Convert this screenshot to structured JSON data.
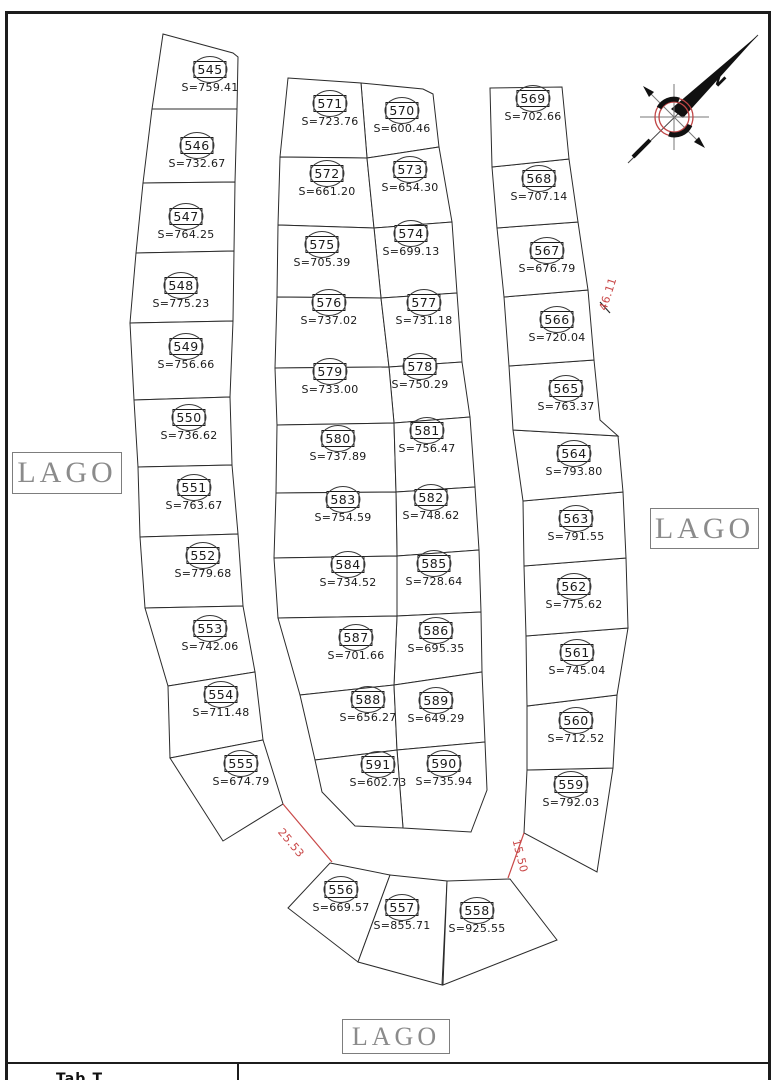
{
  "map": {
    "north_label": "N",
    "line_color": "#2b2b2b",
    "red_color": "#c94848",
    "lago_labels": [
      {
        "text": "LAGO"
      },
      {
        "text": "LAGO"
      },
      {
        "text": "LAGO"
      }
    ],
    "dimensions": [
      {
        "value": "25.53",
        "x": 291,
        "y": 843,
        "rotate": 50,
        "line": [
          283,
          804,
          332,
          862
        ],
        "line_color": "#c94848"
      },
      {
        "value": "15.50",
        "x": 520,
        "y": 856,
        "rotate": 76,
        "line": [
          524,
          833,
          508,
          878
        ],
        "line_color": "#c94848"
      },
      {
        "value": "46.11",
        "x": 608,
        "y": 294,
        "rotate": -72,
        "line": [
          600,
          302,
          610,
          313
        ],
        "line_color": "#2b2b2b"
      }
    ],
    "lots": [
      {
        "num": "545",
        "area": "S=759.41",
        "poly": "163,34 233,53 238,57 237,109 152,109",
        "lx": 210,
        "ly": 72
      },
      {
        "num": "546",
        "area": "S=732.67",
        "poly": "152,109 237,109 235,182 143,183",
        "lx": 197,
        "ly": 148
      },
      {
        "num": "547",
        "area": "S=764.25",
        "poly": "143,183 235,182 234,251 136,253",
        "lx": 186,
        "ly": 219
      },
      {
        "num": "548",
        "area": "S=775.23",
        "poly": "136,253 234,251 233,321 130,323",
        "lx": 181,
        "ly": 288
      },
      {
        "num": "549",
        "area": "S=756.66",
        "poly": "130,323 233,321 230,397 134,400",
        "lx": 186,
        "ly": 349
      },
      {
        "num": "550",
        "area": "S=736.62",
        "poly": "134,400 230,397 232,465 138,467",
        "lx": 189,
        "ly": 420
      },
      {
        "num": "551",
        "area": "S=763.67",
        "poly": "138,467 232,465 238,534 140,537",
        "lx": 194,
        "ly": 490
      },
      {
        "num": "552",
        "area": "S=779.68",
        "poly": "140,537 238,534 243,606 145,608",
        "lx": 203,
        "ly": 558
      },
      {
        "num": "553",
        "area": "S=742.06",
        "poly": "145,608 243,606 255,672 168,686",
        "lx": 210,
        "ly": 631
      },
      {
        "num": "554",
        "area": "S=711.48",
        "poly": "168,686 255,672 263,740 170,758",
        "lx": 221,
        "ly": 697
      },
      {
        "num": "555",
        "area": "S=674.79",
        "poly": "170,758 263,740 283,804 223,841",
        "lx": 241,
        "ly": 766
      },
      {
        "num": "556",
        "area": "S=669.57",
        "poly": "330,863 390,875 358,962 288,908",
        "lx": 341,
        "ly": 892
      },
      {
        "num": "557",
        "area": "S=855.71",
        "poly": "390,875 447,881 442,985 358,962",
        "lx": 402,
        "ly": 910
      },
      {
        "num": "558",
        "area": "S=925.55",
        "poly": "447,881 510,879 557,940 443,985",
        "lx": 477,
        "ly": 913
      },
      {
        "num": "559",
        "area": "S=792.03",
        "poly": "527,770 613,768 597,872 524,833",
        "lx": 571,
        "ly": 787
      },
      {
        "num": "560",
        "area": "S=712.52",
        "poly": "527,706 617,695 613,768 527,770",
        "lx": 576,
        "ly": 723
      },
      {
        "num": "561",
        "area": "S=745.04",
        "poly": "526,636 628,628 617,695 527,706",
        "lx": 577,
        "ly": 655
      },
      {
        "num": "562",
        "area": "S=775.62",
        "poly": "524,566 626,558 628,628 526,636",
        "lx": 574,
        "ly": 589
      },
      {
        "num": "563",
        "area": "S=791.55",
        "poly": "523,501 623,492 626,558 524,566",
        "lx": 576,
        "ly": 521
      },
      {
        "num": "564",
        "area": "S=793.80",
        "poly": "513,430 618,436 623,492 523,501",
        "lx": 574,
        "ly": 456
      },
      {
        "num": "565",
        "area": "S=763.37",
        "poly": "509,366 594,360 600,420 618,436 513,430",
        "lx": 566,
        "ly": 391
      },
      {
        "num": "566",
        "area": "S=720.04",
        "poly": "504,297 588,290 594,360 509,366",
        "lx": 557,
        "ly": 322
      },
      {
        "num": "567",
        "area": "S=676.79",
        "poly": "497,228 578,222 588,290 504,297",
        "lx": 547,
        "ly": 253
      },
      {
        "num": "568",
        "area": "S=707.14",
        "poly": "492,167 569,159 578,222 497,228",
        "lx": 539,
        "ly": 181
      },
      {
        "num": "569",
        "area": "S=702.66",
        "poly": "490,88 562,87 569,159 492,167",
        "lx": 533,
        "ly": 101
      },
      {
        "num": "570",
        "area": "S=600.46",
        "poly": "361,83 423,89 433,94 439,147 367,158",
        "lx": 402,
        "ly": 113
      },
      {
        "num": "571",
        "area": "S=723.76",
        "poly": "288,78 361,83 367,158 280,157",
        "lx": 330,
        "ly": 106
      },
      {
        "num": "572",
        "area": "S=661.20",
        "poly": "280,157 367,158 374,228 278,225",
        "lx": 327,
        "ly": 176
      },
      {
        "num": "573",
        "area": "S=654.30",
        "poly": "367,158 439,147 452,222 374,228",
        "lx": 410,
        "ly": 172
      },
      {
        "num": "574",
        "area": "S=699.13",
        "poly": "374,228 452,222 457,293 381,298",
        "lx": 411,
        "ly": 236
      },
      {
        "num": "575",
        "area": "S=705.39",
        "poly": "278,225 374,228 381,298 277,297",
        "lx": 322,
        "ly": 247
      },
      {
        "num": "576",
        "area": "S=737.02",
        "poly": "277,297 381,298 389,367 275,368",
        "lx": 329,
        "ly": 305
      },
      {
        "num": "577",
        "area": "S=731.18",
        "poly": "381,298 457,293 462,362 389,367",
        "lx": 424,
        "ly": 305
      },
      {
        "num": "578",
        "area": "S=750.29",
        "poly": "389,367 462,362 470,417 394,423",
        "lx": 420,
        "ly": 369
      },
      {
        "num": "579",
        "area": "S=733.00",
        "poly": "275,368 389,367 394,423 277,425",
        "lx": 330,
        "ly": 374
      },
      {
        "num": "580",
        "area": "S=737.89",
        "poly": "277,425 394,423 396,492 276,493",
        "lx": 338,
        "ly": 441
      },
      {
        "num": "581",
        "area": "S=756.47",
        "poly": "394,423 470,417 475,487 396,492",
        "lx": 427,
        "ly": 433
      },
      {
        "num": "582",
        "area": "S=748.62",
        "poly": "396,492 475,487 479,550 397,556",
        "lx": 431,
        "ly": 500
      },
      {
        "num": "583",
        "area": "S=754.59",
        "poly": "276,493 396,492 397,556 274,558",
        "lx": 343,
        "ly": 502
      },
      {
        "num": "584",
        "area": "S=734.52",
        "poly": "274,558 397,556 397,616 278,618",
        "lx": 348,
        "ly": 567
      },
      {
        "num": "585",
        "area": "S=728.64",
        "poly": "397,556 479,550 481,612 397,616",
        "lx": 434,
        "ly": 566
      },
      {
        "num": "586",
        "area": "S=695.35",
        "poly": "397,616 481,612 482,672 394,685",
        "lx": 436,
        "ly": 633
      },
      {
        "num": "587",
        "area": "S=701.66",
        "poly": "278,618 397,616 394,685 300,695",
        "lx": 356,
        "ly": 640
      },
      {
        "num": "588",
        "area": "S=656.27",
        "poly": "300,695 394,685 397,750 315,760",
        "lx": 368,
        "ly": 702
      },
      {
        "num": "589",
        "area": "S=649.29",
        "poly": "394,685 482,672 485,742 397,750",
        "lx": 436,
        "ly": 703
      },
      {
        "num": "590",
        "area": "S=735.94",
        "poly": "397,750 485,742 487,790 471,832 403,828",
        "lx": 444,
        "ly": 766
      },
      {
        "num": "591",
        "area": "S=602.73",
        "poly": "315,760 397,750 403,828 355,826 322,792",
        "lx": 378,
        "ly": 767
      }
    ]
  },
  "title_block": {
    "fragment": "Tab.T"
  }
}
